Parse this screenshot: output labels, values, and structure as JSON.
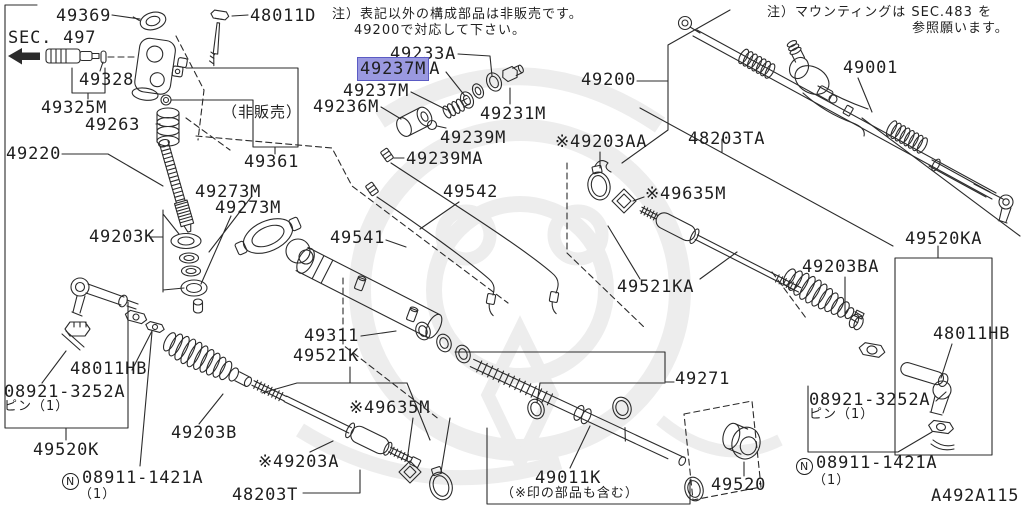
{
  "diagram": {
    "drawing_code": "A492A115",
    "selected_part": "49237M",
    "colors": {
      "line": "#2b2b2b",
      "text": "#1f1f1f",
      "background": "#ffffff",
      "watermark": "#ededed",
      "highlight_fill": "#9a99e0",
      "highlight_border": "#5b5bc4"
    },
    "notes": {
      "main_1": "注）表記以外の構成部品は非販売です。",
      "main_2": "49200で対応して下さい。",
      "mounting_1": "注）マウンティングは SEC.483 を",
      "mounting_2": "参照願います。"
    },
    "labels": [
      {
        "text": "49369"
      },
      {
        "text": "48011D"
      },
      {
        "text": "SEC. 497"
      },
      {
        "text": "49328"
      },
      {
        "text": "49325M"
      },
      {
        "text": "49263"
      },
      {
        "text": "49220"
      },
      {
        "text": "（非販売）"
      },
      {
        "text": "49361"
      },
      {
        "text": "49233A"
      },
      {
        "hl": "49237M",
        "tail": "A"
      },
      {
        "text": "49237M"
      },
      {
        "text": "49236M"
      },
      {
        "text": "49231M"
      },
      {
        "text": "49239M"
      },
      {
        "text": "49239MA"
      },
      {
        "text": "49200"
      },
      {
        "text": "※49203AA"
      },
      {
        "text": "48203TA"
      },
      {
        "text": "※49635M"
      },
      {
        "text": "49001"
      },
      {
        "text": "49542"
      },
      {
        "text": "49541"
      },
      {
        "text": "49273M"
      },
      {
        "text": "49273M"
      },
      {
        "text": "49203K"
      },
      {
        "text": "49521KA"
      },
      {
        "text": "49203BA"
      },
      {
        "text": "49520KA"
      },
      {
        "text": "48011HB"
      },
      {
        "text": "08921-3252A"
      },
      {
        "text": "ピン（1）"
      },
      {
        "prefix": "N",
        "text": "08911-1421A"
      },
      {
        "text": "（1）"
      },
      {
        "text": "49311"
      },
      {
        "text": "49521K"
      },
      {
        "text": "※49635M"
      },
      {
        "text": "49271"
      },
      {
        "text": "※49203A"
      },
      {
        "text": "48203T"
      },
      {
        "text": "49203B"
      },
      {
        "text": "48011HB"
      },
      {
        "text": "08921-3252A"
      },
      {
        "text": "ピン（1）"
      },
      {
        "text": "49520K"
      },
      {
        "prefix": "N",
        "text": "08911-1421A"
      },
      {
        "text": "（1）"
      },
      {
        "text": "49011K"
      },
      {
        "text": "（※印の部品も含む）"
      },
      {
        "text": "49520"
      }
    ]
  }
}
